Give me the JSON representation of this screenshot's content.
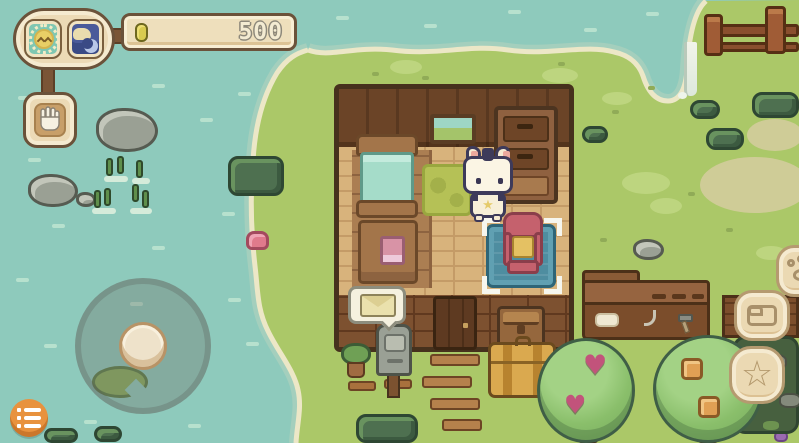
{
  "hud": {
    "status_group": {
      "day_icon": "sun-character-face",
      "night_icon": "sleeping-cat-and-moon"
    },
    "currency_bar": {
      "coin_icon": "coin",
      "amount": "500"
    },
    "hand_button": {
      "icon": "hand-glove"
    },
    "menu_button": {
      "icon": "list-menu"
    },
    "joystick": {
      "type": "virtual-joystick"
    },
    "right_buttons": [
      {
        "id": "paw-button",
        "icon": "paw-print"
      },
      {
        "id": "bag-button",
        "icon": "satchel-bag"
      },
      {
        "id": "star-button",
        "icon": "star-outline"
      }
    ]
  },
  "glyphs": {
    "heart_fruit": "♥",
    "star_outline": "☆",
    "cat_badge_star": "★"
  },
  "world": {
    "character": "white-cat-villager",
    "house": {
      "furniture": [
        "bed",
        "bedside-table-with-book",
        "picture-frame",
        "dresser",
        "green-rug",
        "blue-rug",
        "pink-armchair",
        "door",
        "wooden-chest"
      ]
    },
    "placement_selection": "pink-armchair-on-blue-rug",
    "outdoor_objects": [
      "mailbox",
      "mail-bubble",
      "potted-plant",
      "stone-steps",
      "suitcase",
      "workbench",
      "heart-fruit-tree",
      "orange-fruit-tree",
      "pond",
      "fence",
      "waterfall",
      "rocks",
      "reeds",
      "bushes",
      "water-lily-flower",
      "lily-pad"
    ]
  },
  "colors": {
    "water": "#8ecabc",
    "grass": "#abc868",
    "shore": "#ebe6c6",
    "ui_cream": "#ecdab6",
    "ui_border_brown": "#6b523a",
    "menu_orange": "#e8923e",
    "selection_white": "#f6f6ee",
    "currency_text": "#f3ebd2"
  }
}
